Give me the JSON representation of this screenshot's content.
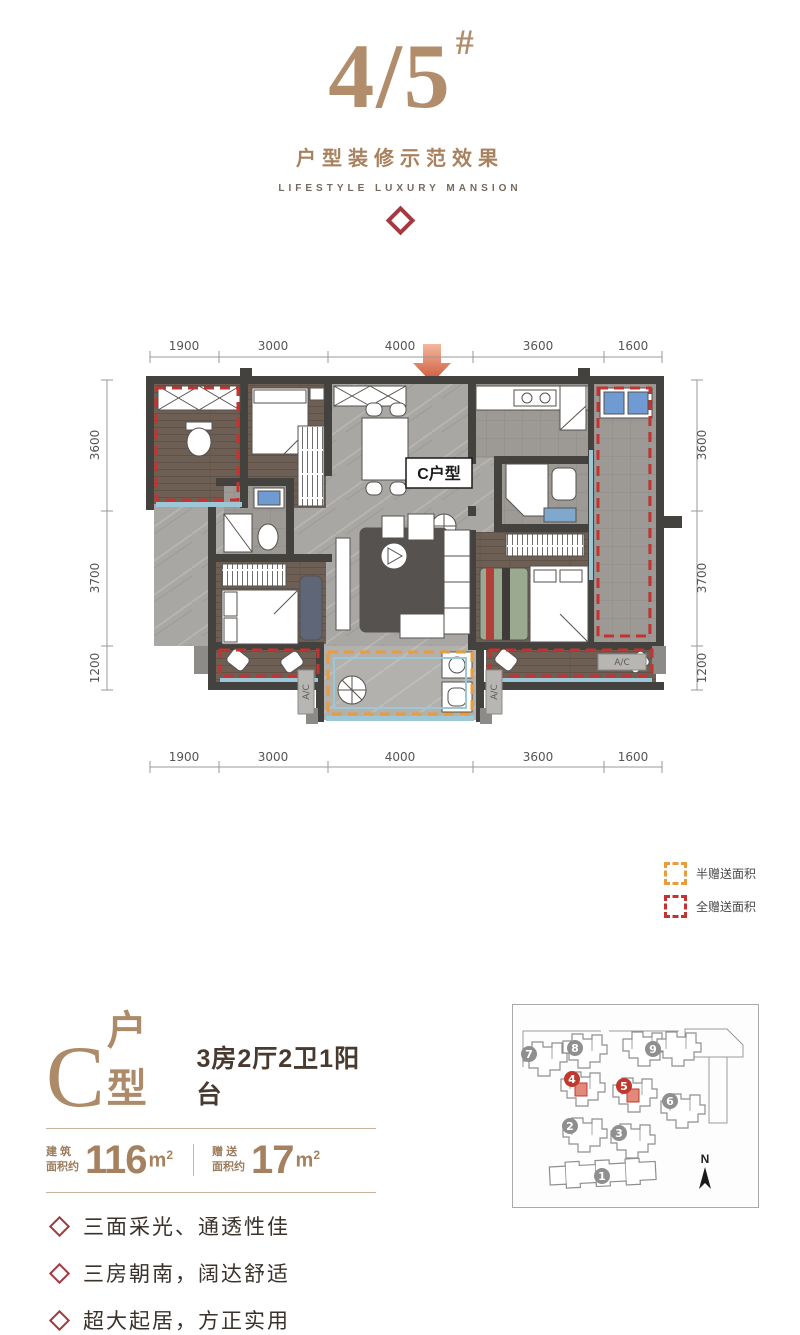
{
  "header": {
    "title": "4/5",
    "title_hash": "#",
    "subtitle": "户型装修示范效果",
    "tagline": "LIFESTYLE LUXURY MANSION"
  },
  "plan": {
    "unit_label": "C户型",
    "ac_label": "A/C",
    "dims_top": [
      "1900",
      "3000",
      "4000",
      "3600",
      "1600"
    ],
    "dims_bottom": [
      "1900",
      "3000",
      "4000",
      "3600",
      "1600"
    ],
    "dims_left": [
      "3600",
      "3700",
      "1200"
    ],
    "dims_right": [
      "3600",
      "3700",
      "1200"
    ]
  },
  "legend": {
    "half_label": "半赠送面积",
    "full_label": "全赠送面积"
  },
  "unit_info": {
    "letter": "C",
    "type_suffix": "户型",
    "layout_text": "3房2厅2卫1阳台",
    "build_label_line1": "建 筑",
    "build_label_line2": "面积约",
    "build_value": "116",
    "build_unit": "m",
    "build_sup": "2",
    "gift_label_line1": "赠 送",
    "gift_label_line2": "面积约",
    "gift_value": "17",
    "gift_unit": "m",
    "gift_sup": "2",
    "features": [
      "三面采光、通透性佳",
      "三房朝南，阔达舒适",
      "超大起居，方正实用"
    ]
  },
  "sitemap": {
    "north_label": "N",
    "buildings": [
      {
        "label": "7",
        "highlight": false
      },
      {
        "label": "8",
        "highlight": false
      },
      {
        "label": "9",
        "highlight": false
      },
      {
        "label": "4",
        "highlight": true
      },
      {
        "label": "5",
        "highlight": true
      },
      {
        "label": "6",
        "highlight": false
      },
      {
        "label": "2",
        "highlight": false
      },
      {
        "label": "3",
        "highlight": false
      },
      {
        "label": "1",
        "highlight": false
      }
    ]
  },
  "colors": {
    "brand_brown": "#ad8a68",
    "accent_red": "#a13b42",
    "gift_full_red": "#c63230",
    "gift_half_orange": "#e89c3c",
    "highlight_red": "#c0392f"
  }
}
